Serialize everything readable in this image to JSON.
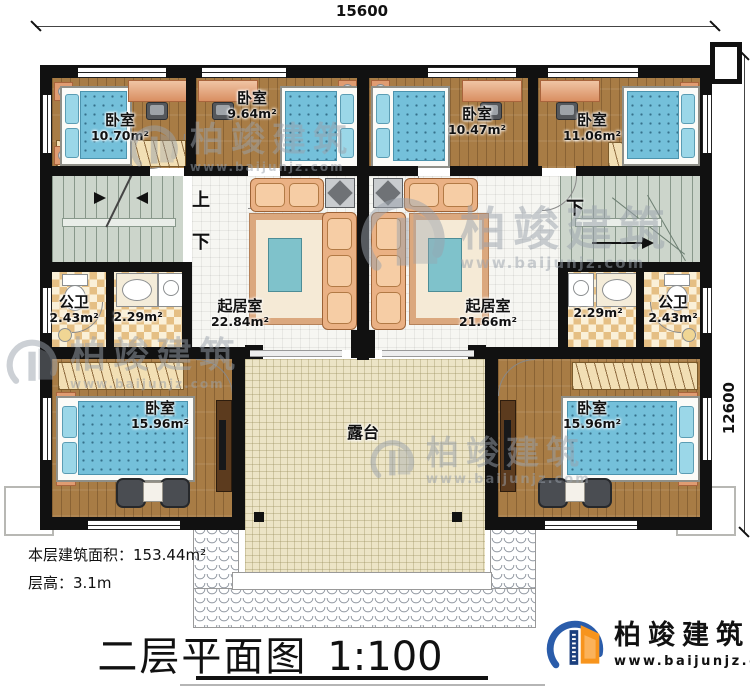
{
  "dimensions": {
    "width_top": "15600",
    "height_right": "12600"
  },
  "labels": {
    "up": "上",
    "down": "下"
  },
  "rooms": {
    "bed_tl": {
      "name": "卧室",
      "area": "10.70m²"
    },
    "bed_tml": {
      "name": "卧室",
      "area": "9.64m²"
    },
    "bed_tmr": {
      "name": "卧室",
      "area": "10.47m²"
    },
    "bed_tr": {
      "name": "卧室",
      "area": "11.06m²"
    },
    "wc_l": {
      "name": "公卫",
      "area": "2.43m²"
    },
    "wash_l": {
      "area": "2.29m²"
    },
    "wash_r": {
      "area": "2.29m²"
    },
    "wc_r": {
      "name": "公卫",
      "area": "2.43m²"
    },
    "living_l": {
      "name": "起居室",
      "area": "22.84m²"
    },
    "living_r": {
      "name": "起居室",
      "area": "21.66m²"
    },
    "bed_bl": {
      "name": "卧室",
      "area": "15.96m²"
    },
    "bed_br": {
      "name": "卧室",
      "area": "15.96m²"
    },
    "terrace": {
      "name": "露台"
    }
  },
  "footer": {
    "floor_area": "本层建筑面积：153.44m²",
    "floor_height": "层高：3.1m"
  },
  "title": {
    "text": "二层平面图",
    "scale": "1:100"
  },
  "brand": {
    "name": "柏竣建筑",
    "url": "www.baijunjz.com"
  },
  "colors": {
    "accent_blue": "#2a5caa",
    "accent_orange": "#f7941d",
    "wall": "#111111"
  }
}
